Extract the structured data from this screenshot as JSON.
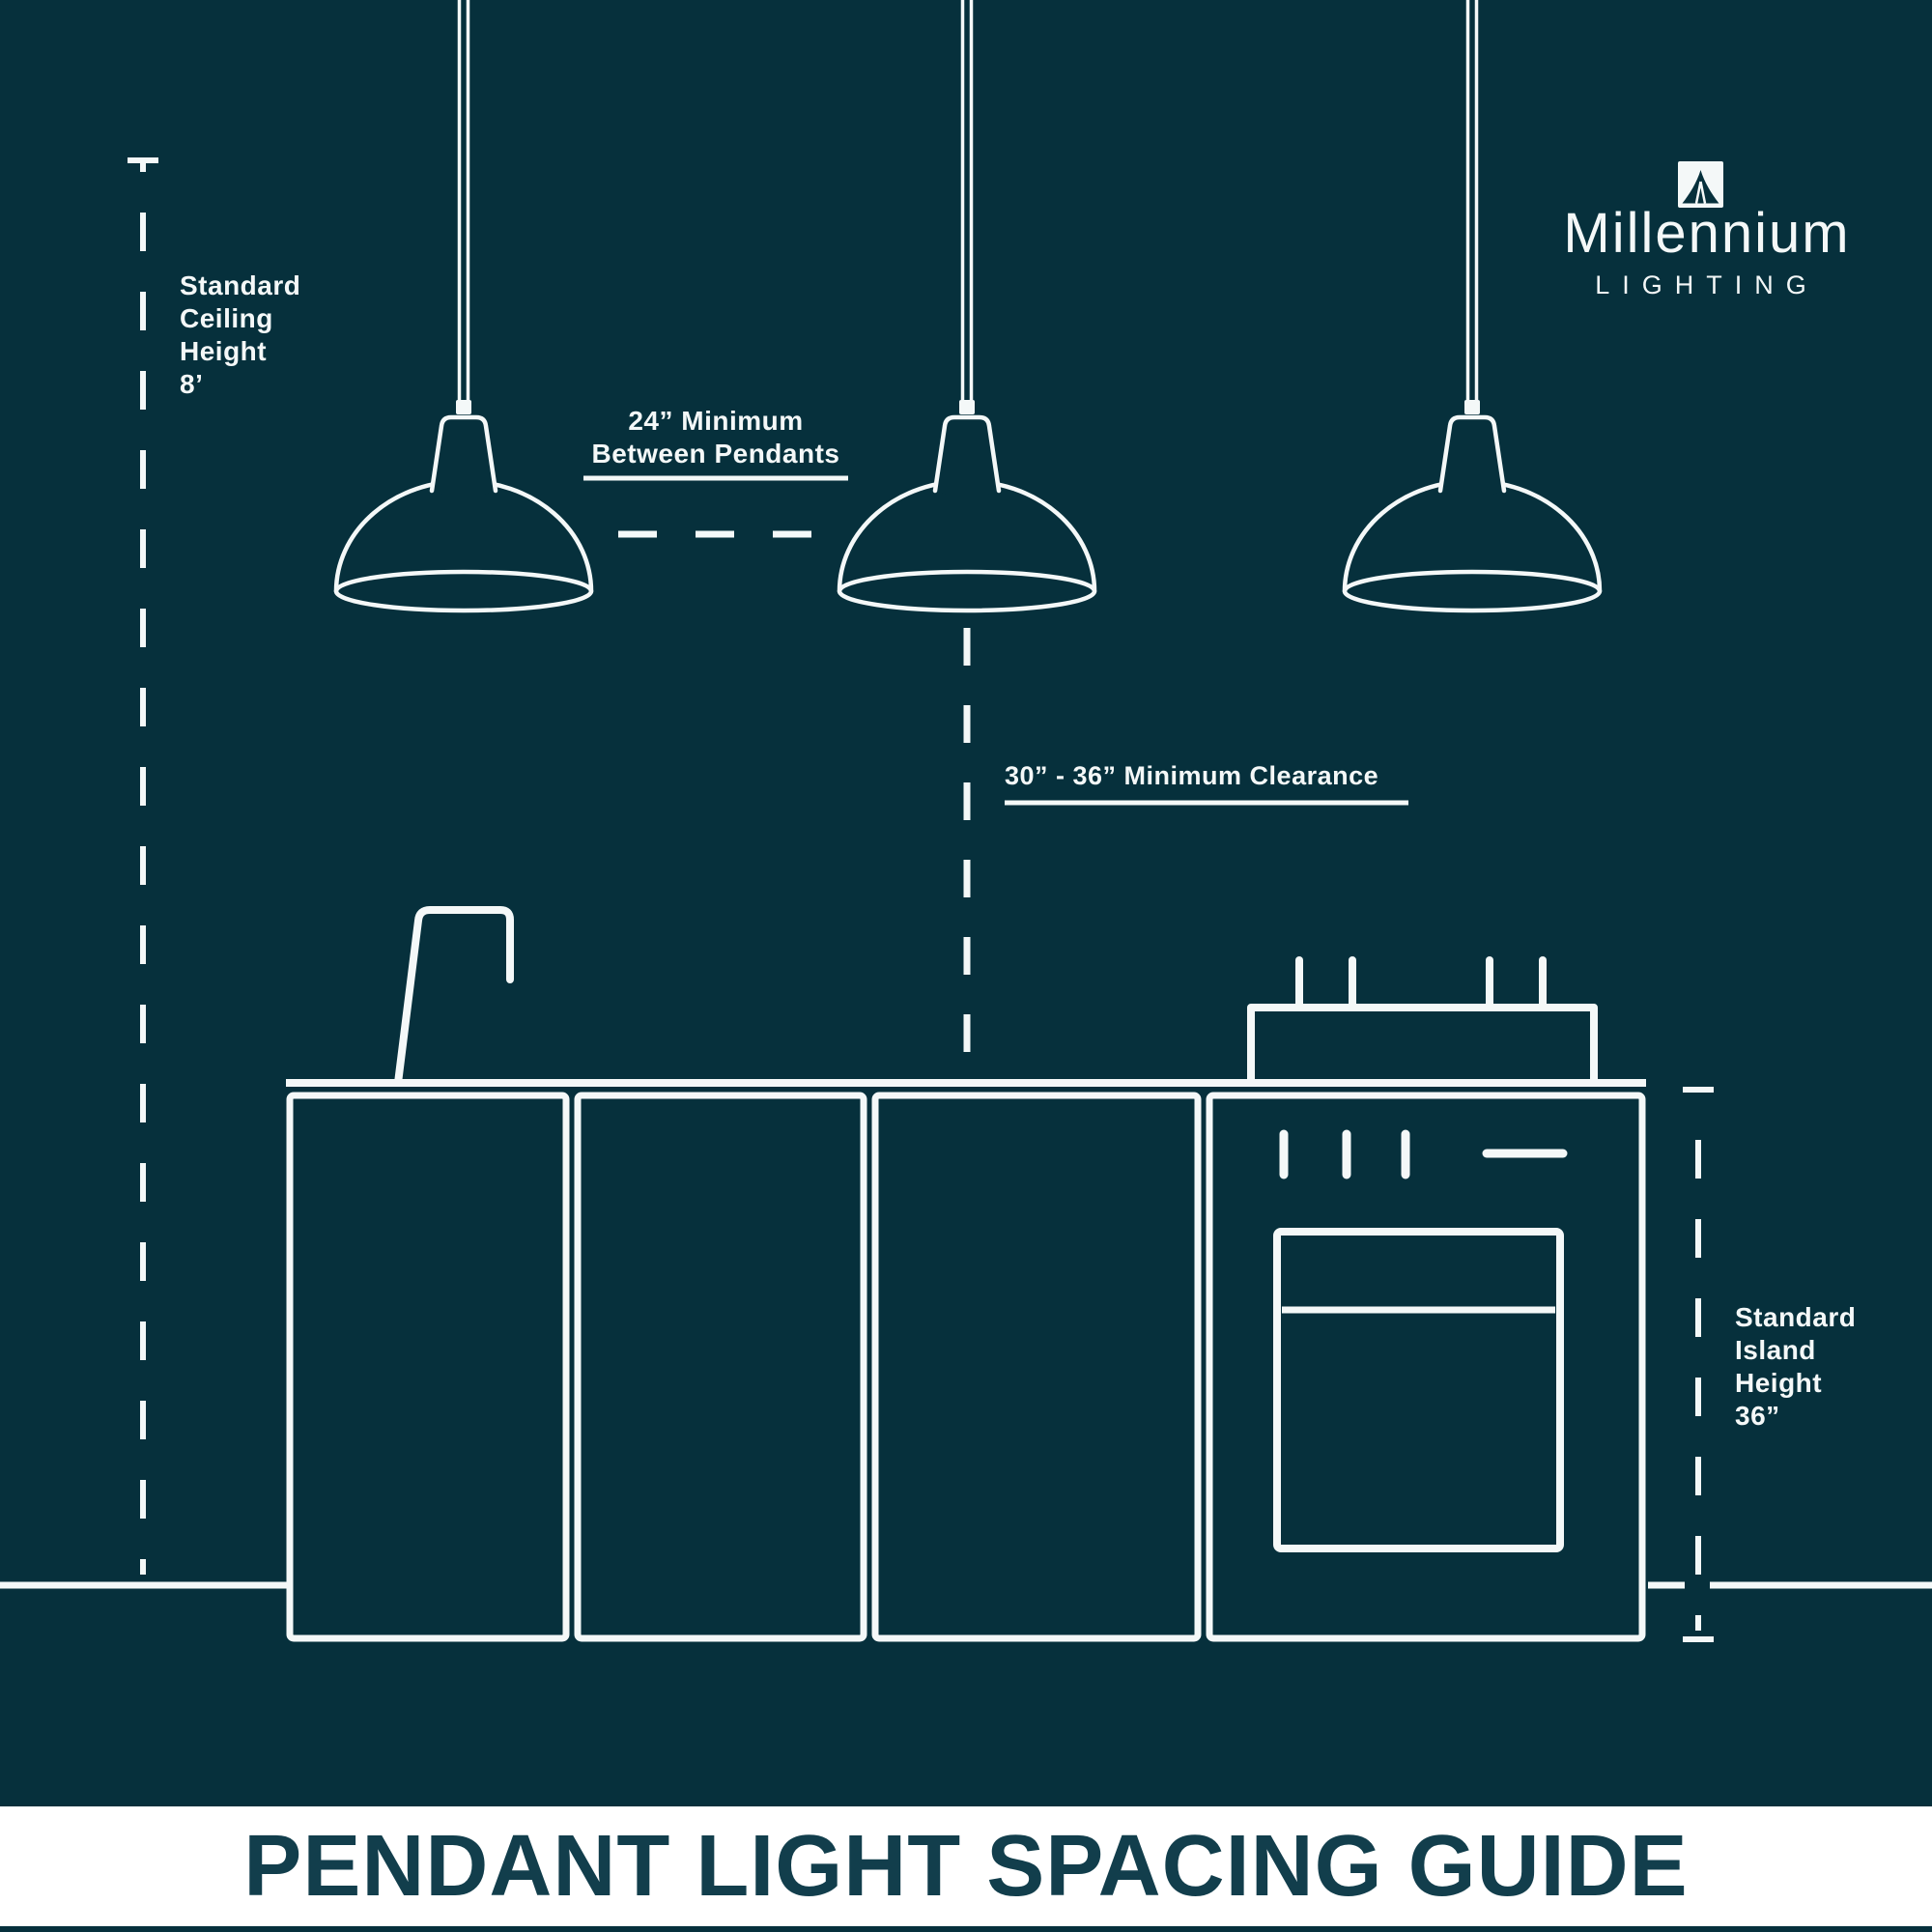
{
  "colors": {
    "background": "#06303c",
    "line": "#f4f8f8",
    "banner_background": "#ffffff",
    "banner_text": "#123e4c"
  },
  "logo": {
    "icon": "millennium-pendant-icon",
    "name": "Millennium",
    "tagline": "LIGHTING"
  },
  "annotations": {
    "ceiling": "Standard\nCeiling\nHeight\n8’",
    "between_pendants": "24” Minimum\nBetween Pendants",
    "clearance": "30” - 36” Minimum Clearance",
    "island": "Standard\nIsland\nHeight\n36”"
  },
  "footer": {
    "title": "PENDANT LIGHT SPACING GUIDE"
  },
  "diagram": {
    "pendant_count": 3
  }
}
